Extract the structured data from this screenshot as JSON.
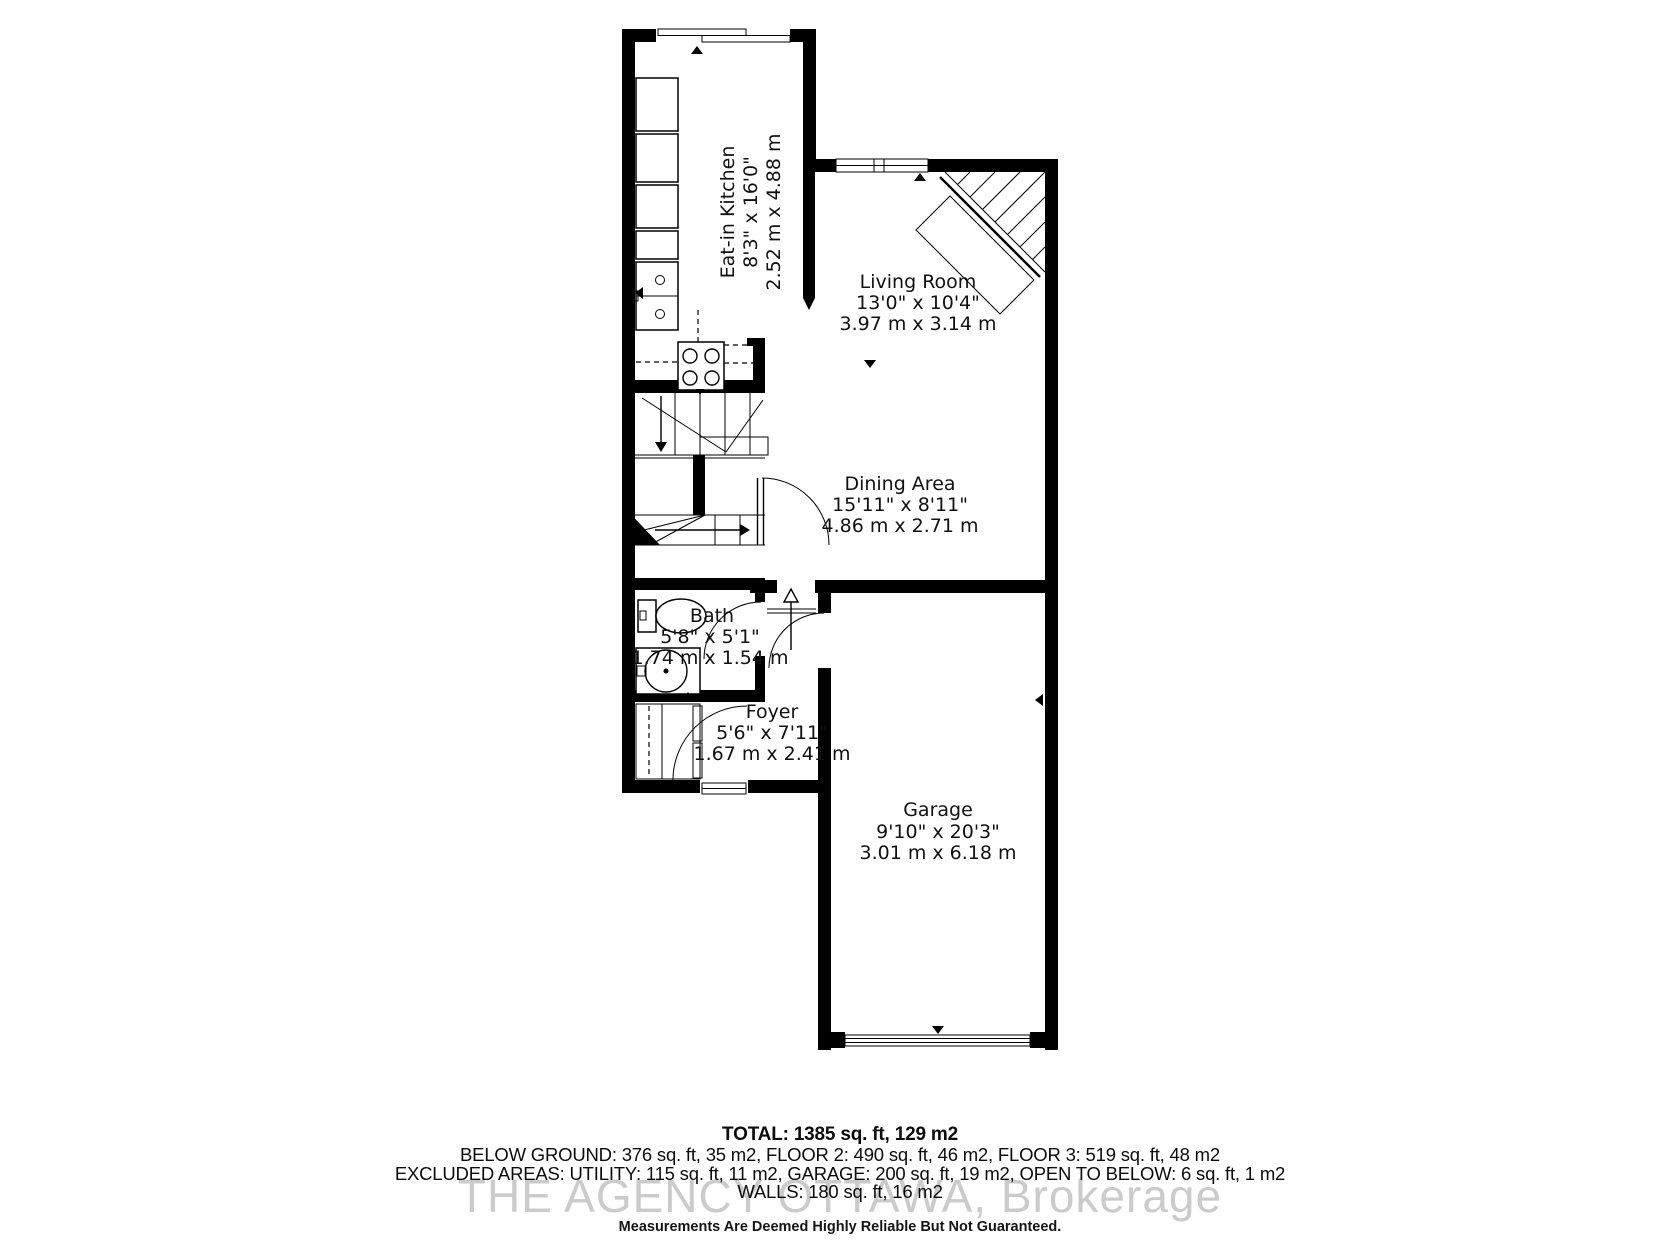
{
  "colors": {
    "background": "#ffffff",
    "walls": "#000000",
    "label_text": "#111111",
    "watermark": "#c9c9c9"
  },
  "rooms": {
    "kitchen": {
      "name": "Eat-in Kitchen",
      "imperial": "8'3\" x 16'0\"",
      "metric": "2.52 m x 4.88 m"
    },
    "living": {
      "name": "Living Room",
      "imperial": "13'0\" x 10'4\"",
      "metric": "3.97 m x 3.14 m"
    },
    "dining": {
      "name": "Dining Area",
      "imperial": "15'11\" x 8'11\"",
      "metric": "4.86 m x 2.71 m"
    },
    "bath": {
      "name": "Bath",
      "imperial": "5'8\" x 5'1\"",
      "metric": "1.74 m x 1.54 m"
    },
    "foyer": {
      "name": "Foyer",
      "imperial": "5'6\" x 7'11\"",
      "metric": "1.67 m x 2.41 m"
    },
    "garage": {
      "name": "Garage",
      "imperial": "9'10\" x 20'3\"",
      "metric": "3.01 m x 6.18 m"
    }
  },
  "summary": {
    "total": "TOTAL: 1385 sq. ft, 129 m2",
    "floors": "BELOW GROUND: 376 sq. ft, 35 m2, FLOOR 2: 490 sq. ft, 46 m2, FLOOR 3: 519 sq. ft, 48 m2",
    "excluded": "EXCLUDED AREAS: UTILITY: 115 sq. ft, 11 m2, GARAGE: 200 sq. ft, 19 m2, OPEN TO BELOW: 6 sq. ft, 1 m2",
    "walls": "WALLS: 180 sq. ft, 16 m2",
    "disclaimer": "Measurements Are Deemed Highly Reliable But Not Guaranteed."
  },
  "watermark": "THE AGENCY OTTAWA, Brokerage"
}
